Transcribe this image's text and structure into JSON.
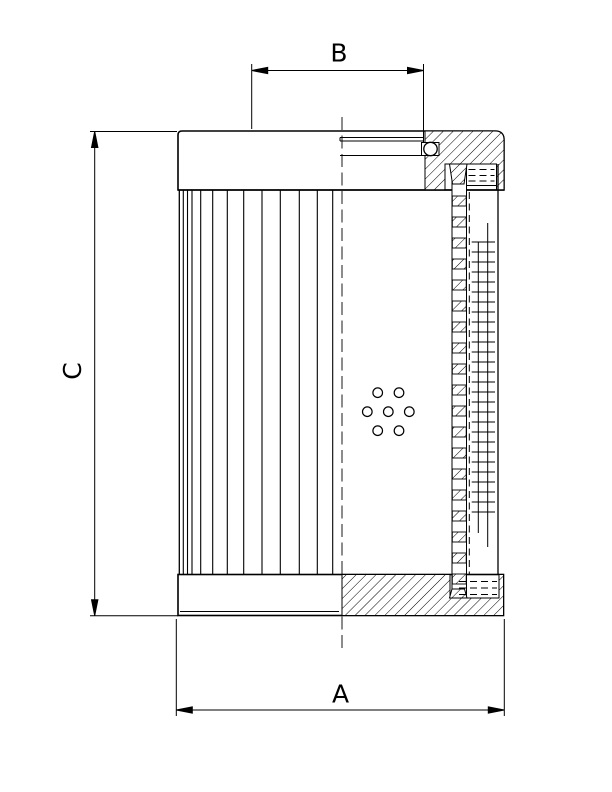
{
  "page": {
    "background_color": "#ffffff",
    "line_color": "#000000"
  },
  "drawing": {
    "title": "filter element section drawing",
    "dimensions": {
      "a_label": "A",
      "b_label": "B",
      "c_label": "C"
    }
  }
}
